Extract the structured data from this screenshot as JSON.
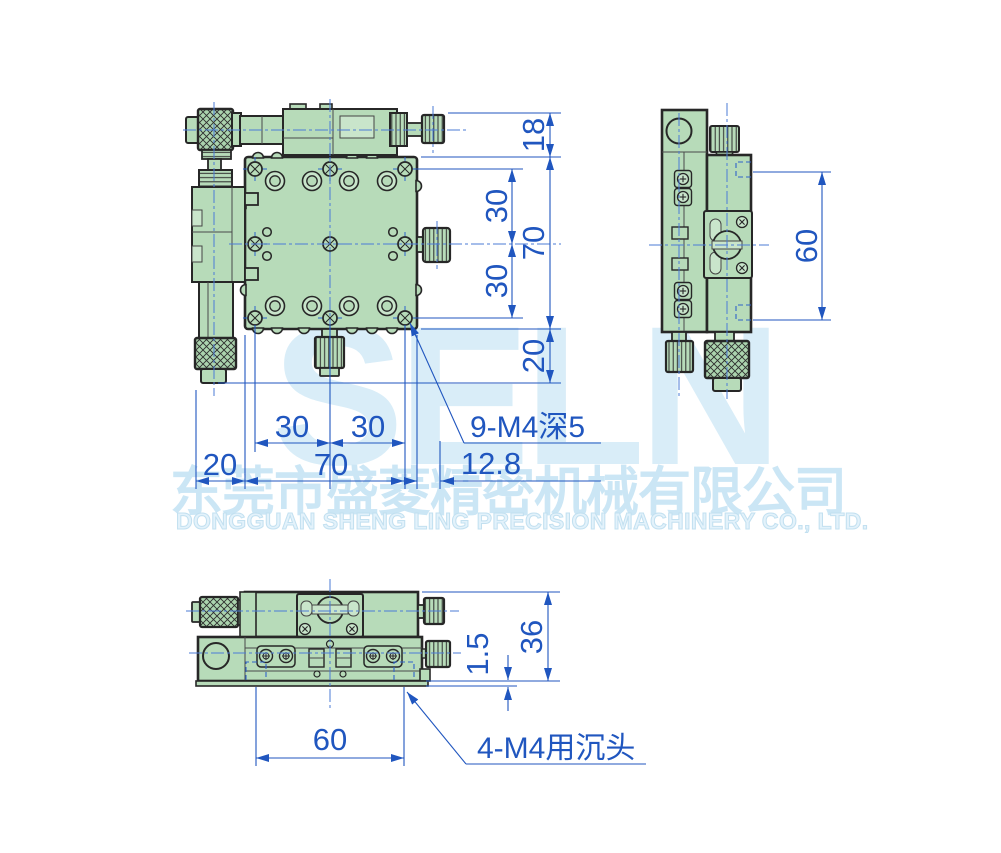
{
  "watermarks": {
    "logo": "SELN",
    "company_cn": "东莞市盛菱精密机械有限公司",
    "company_en": "DONGGUAN SHENG LING PRECISION MACHINERY CO., LTD."
  },
  "plan_view": {
    "dim_18": "18",
    "dim_30_right_upper": "30",
    "dim_30_right_lower": "30",
    "dim_70_right": "70",
    "dim_20_right": "20",
    "dim_30_bottom_left": "30",
    "dim_30_bottom_right": "30",
    "dim_20_bottom": "20",
    "dim_70_bottom": "70",
    "dim_12_8": "12.8",
    "note_holes": "9-M4深5"
  },
  "side_view": {
    "dim_60": "60"
  },
  "front_view": {
    "dim_36": "36",
    "dim_1_5": "1.5",
    "dim_60": "60",
    "note_holes": "4-M4用沉头"
  },
  "colors": {
    "part_fill": "#b7dbb9",
    "outline": "#272727",
    "dimension_blue": "#2056bf",
    "centerline_blue": "#4b7bd6",
    "watermark_blue": "#d9edf8"
  }
}
